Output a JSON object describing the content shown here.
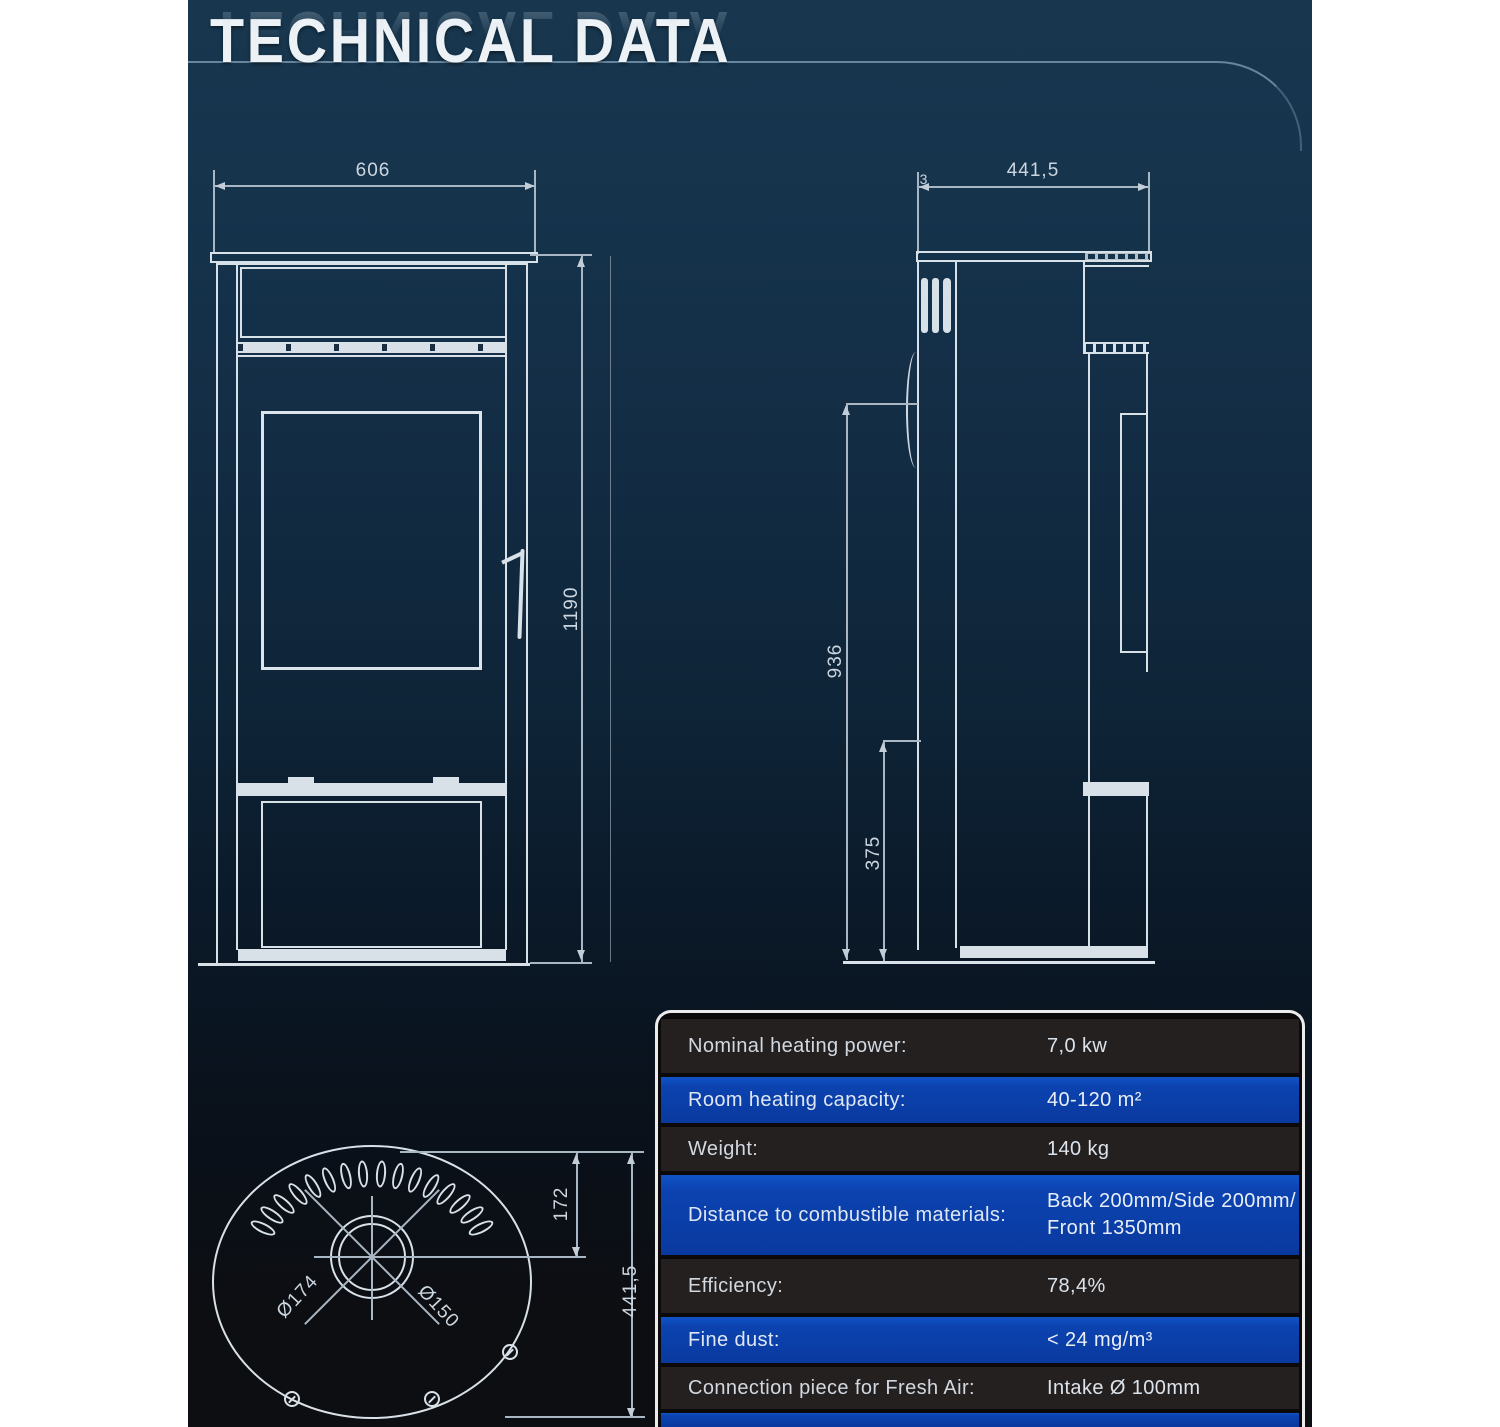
{
  "title": {
    "text": "TECHNICAL DATA"
  },
  "drawings": {
    "front_view": {
      "width": "606",
      "height": "1190"
    },
    "side_view": {
      "depth": "441,5",
      "plate_offset": "3",
      "body_height": "936",
      "base_height": "375"
    },
    "top_view": {
      "flue_center_offset": "172",
      "depth": "441,5",
      "outer_diameter": "Ø174",
      "flue_diameter": "Ø150"
    }
  },
  "spec_table": {
    "rows": [
      {
        "label": "Nominal heating power:",
        "value": "7,0 kw"
      },
      {
        "label": "Room heating capacity:",
        "value": "40-120 m²"
      },
      {
        "label": "Weight:",
        "value": "140 kg"
      },
      {
        "label": "Distance to combustible materials:",
        "value": "Back 200mm/Side 200mm/",
        "value_line2": "Front 1350mm"
      },
      {
        "label": "Efficiency:",
        "value": "78,4%"
      },
      {
        "label": "Fine dust:",
        "value": "< 24 mg/m³"
      },
      {
        "label": "Connection piece for Fresh Air:",
        "value": "Intake Ø 100mm"
      }
    ]
  },
  "colors": {
    "panel_navy_top": "#18374f",
    "panel_bottom": "#0d0e11",
    "drawing_line": "#d9e1e8",
    "table_row_blue": "#0c43b0",
    "table_row_dark": "#242020",
    "table_border": "#ececec",
    "page_margin": "#ffffff"
  }
}
